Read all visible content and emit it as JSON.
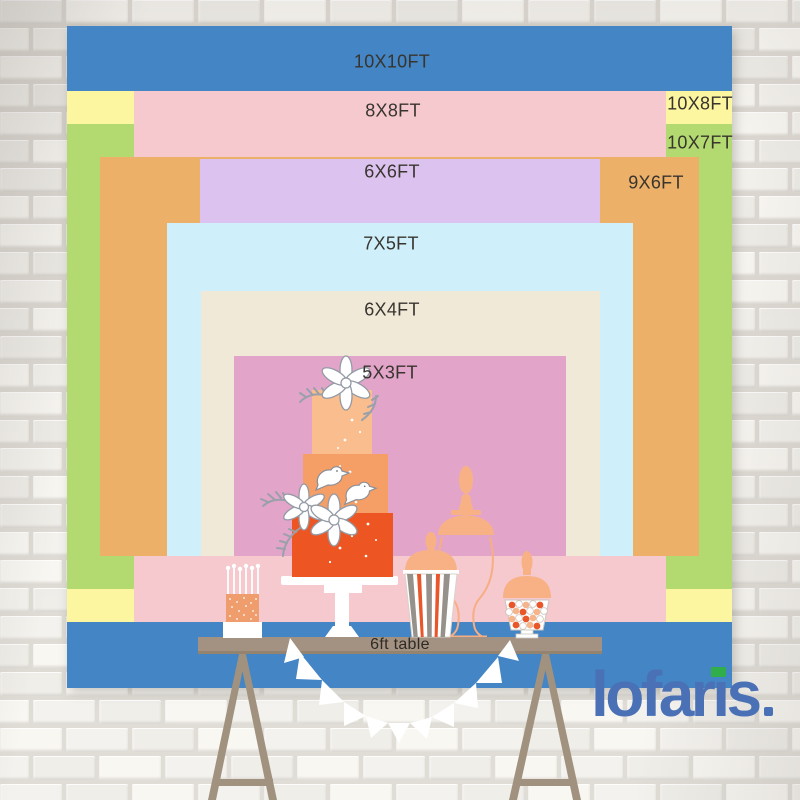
{
  "backdrop": {
    "sizes": [
      {
        "id": "10x10",
        "label": "10X10FT",
        "width_ft": 10,
        "height_ft": 10,
        "color": "#4385c5"
      },
      {
        "id": "8x8",
        "label": "8X8FT",
        "width_ft": 8,
        "height_ft": 8,
        "color": "#f5c9ce"
      },
      {
        "id": "10x8",
        "label": "10X8FT",
        "width_ft": 10,
        "height_ft": 8,
        "color": "#fcf6a0"
      },
      {
        "id": "10x7",
        "label": "10X7FT",
        "width_ft": 10,
        "height_ft": 7,
        "color": "#b3da70"
      },
      {
        "id": "6x6",
        "label": "6X6FT",
        "width_ft": 6,
        "height_ft": 6,
        "color": "#dcc2ee"
      },
      {
        "id": "9x6",
        "label": "9X6FT",
        "width_ft": 9,
        "height_ft": 6,
        "color": "#edb069"
      },
      {
        "id": "7x5",
        "label": "7X5FT",
        "width_ft": 7,
        "height_ft": 5,
        "color": "#cff0fa"
      },
      {
        "id": "6x4",
        "label": "6X4FT",
        "width_ft": 6,
        "height_ft": 4,
        "color": "#f0e9d8"
      },
      {
        "id": "5x3",
        "label": "5X3FT",
        "width_ft": 5,
        "height_ft": 3,
        "color": "#e2a5c9"
      }
    ],
    "table_label": "6ft table"
  },
  "logo": {
    "text_left": "lofar",
    "text_i": "ı",
    "text_right": "s",
    "color": "#4a70b6",
    "dot_color": "#2fae4a"
  },
  "illustration": {
    "table_color": "#a39282",
    "leg_color": "#a1927f",
    "cake_tier_colors": [
      "#f9bd8e",
      "#f59e66",
      "#ed5623"
    ],
    "candle_cake_color": "#f09d6d",
    "jar_color": "#f8b185",
    "stripe_orange": "#e8562a",
    "stripe_gray": "#96918b",
    "garland_color": "#ffffff"
  },
  "wall": {
    "brick_color": "#f3f1ec",
    "mortar_color": "#dcd8d1"
  }
}
